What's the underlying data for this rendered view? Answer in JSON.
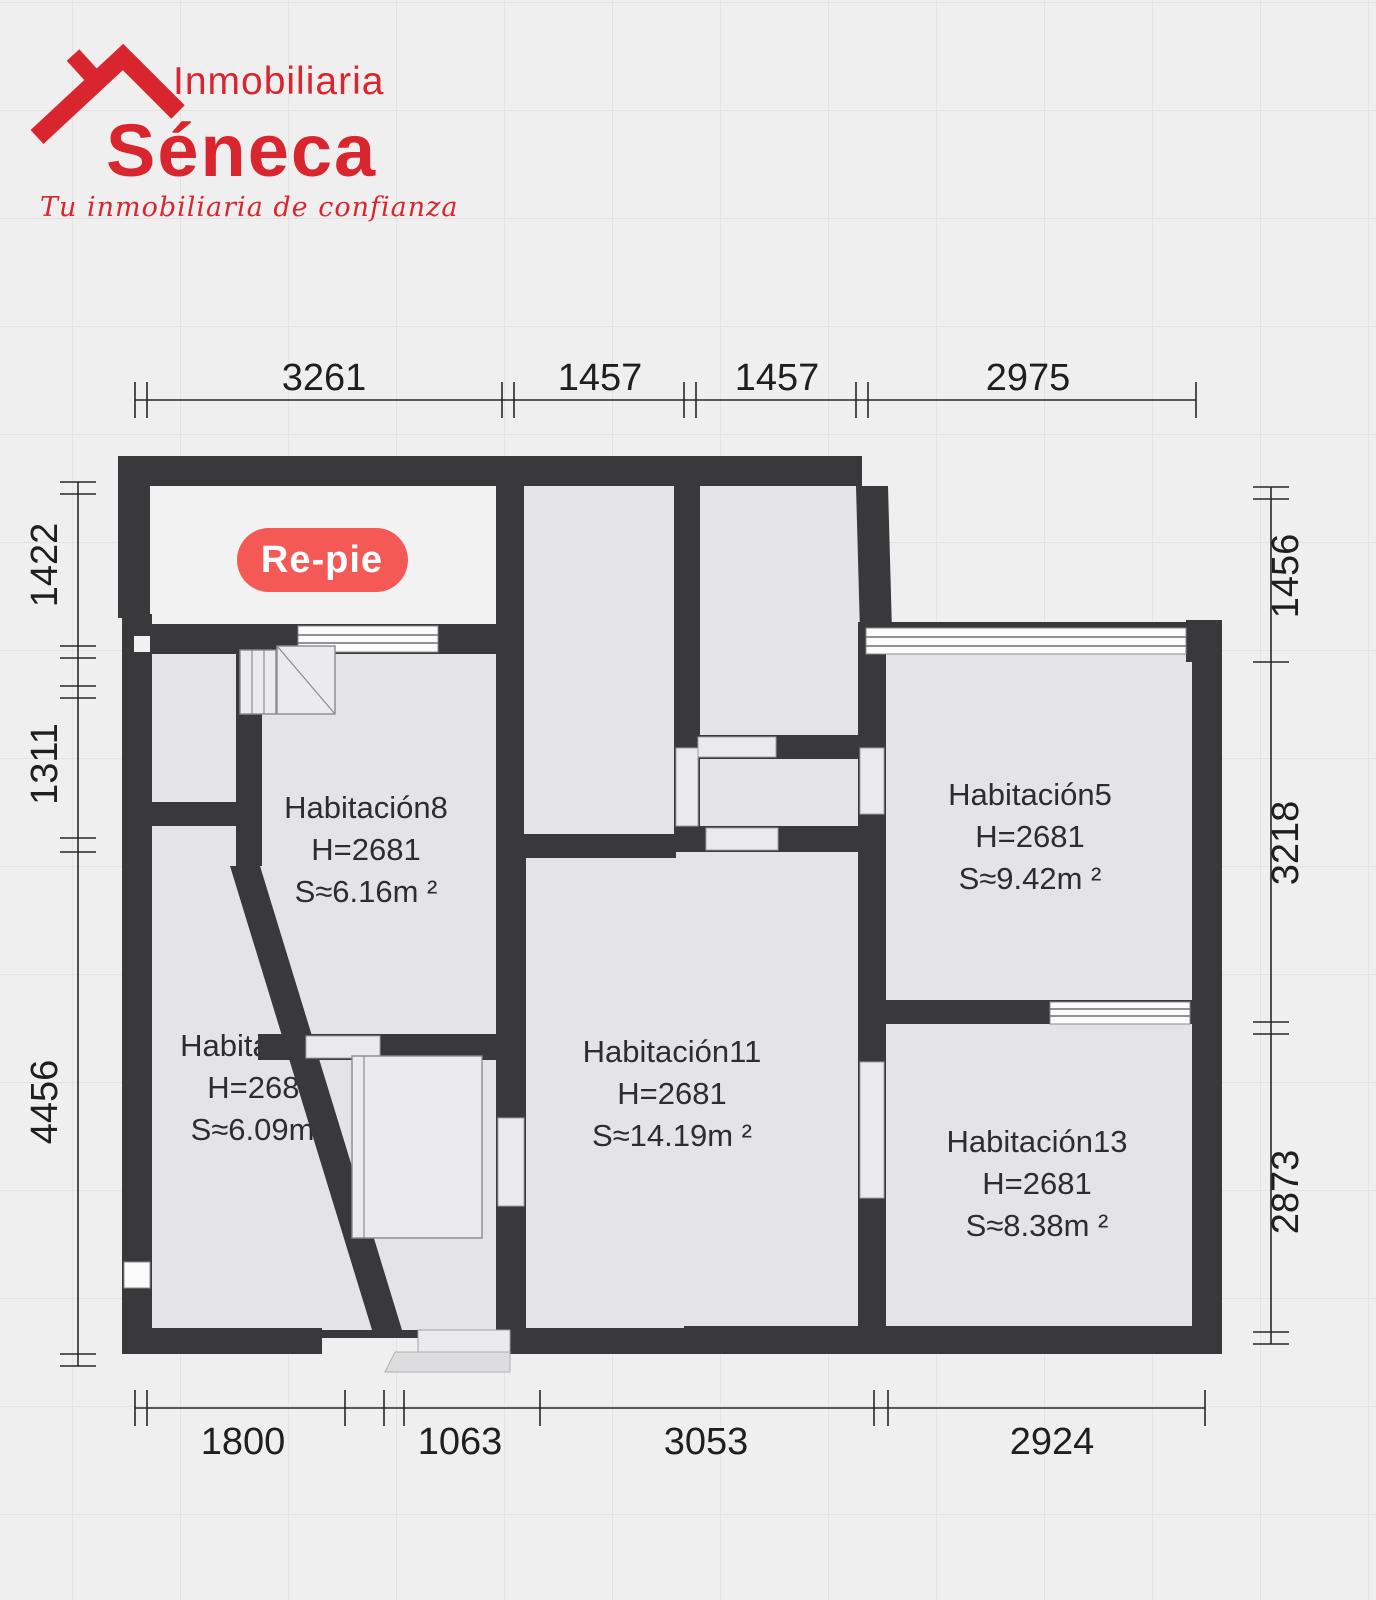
{
  "brand": {
    "name_top": "Inmobiliaria",
    "name_main": "Séneca",
    "tagline": "Tu inmobiliaria de confianza",
    "color": "#d9262e"
  },
  "badge": {
    "label": "Re-pie",
    "color": "#f45956"
  },
  "rooms": {
    "hab8": {
      "name": "Habitación8",
      "height": "H=2681",
      "area": "S≈6.16m ²"
    },
    "hab2": {
      "name": "Habitación2",
      "height": "H=2681",
      "area": "S≈6.09m ²"
    },
    "hab11": {
      "name": "Habitación11",
      "height": "H=2681",
      "area": "S≈14.19m ²"
    },
    "hab5": {
      "name": "Habitación5",
      "height": "H=2681",
      "area": "S≈9.42m ²"
    },
    "hab13": {
      "name": "Habitación13",
      "height": "H=2681",
      "area": "S≈8.38m ²"
    }
  },
  "dimensions": {
    "top": [
      "3261",
      "1457",
      "1457",
      "2975"
    ],
    "bottom": [
      "1800",
      "1063",
      "3053",
      "2924"
    ],
    "left": [
      "1422",
      "1311",
      "4456"
    ],
    "right": [
      "1456",
      "3218",
      "2873"
    ]
  },
  "colors": {
    "wall": "#39393b",
    "room_fill": "#e4e4e6",
    "background": "#f0efef"
  }
}
